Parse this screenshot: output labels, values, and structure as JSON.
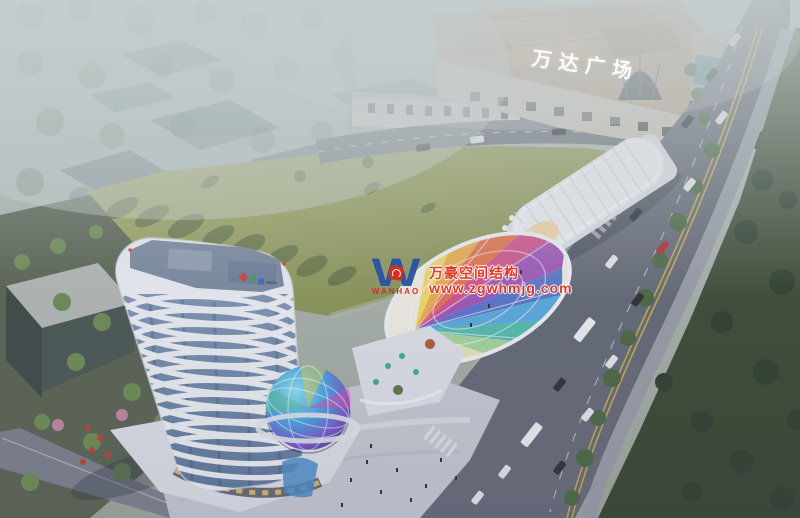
{
  "scene": {
    "description": "Aerial dusk rendering of a mixed-use commercial plaza: curved high-rise tower, rainbow membrane canopy, iridescent glass dome, retail strips, large lawn, Wanda Plaza mall and tree-lined avenue",
    "render_style": "architectural-visualization"
  },
  "signs": {
    "mall_roof_sign": "万达广场"
  },
  "watermark": {
    "logo_letter": "W",
    "logo_text": "WANHAO",
    "brand_line": "万豪空间结构",
    "url_line": "www.zgwhmjg.com",
    "text_color": "#e23423",
    "logo_blue": "#2a52a0",
    "logo_red": "#d42b20"
  }
}
